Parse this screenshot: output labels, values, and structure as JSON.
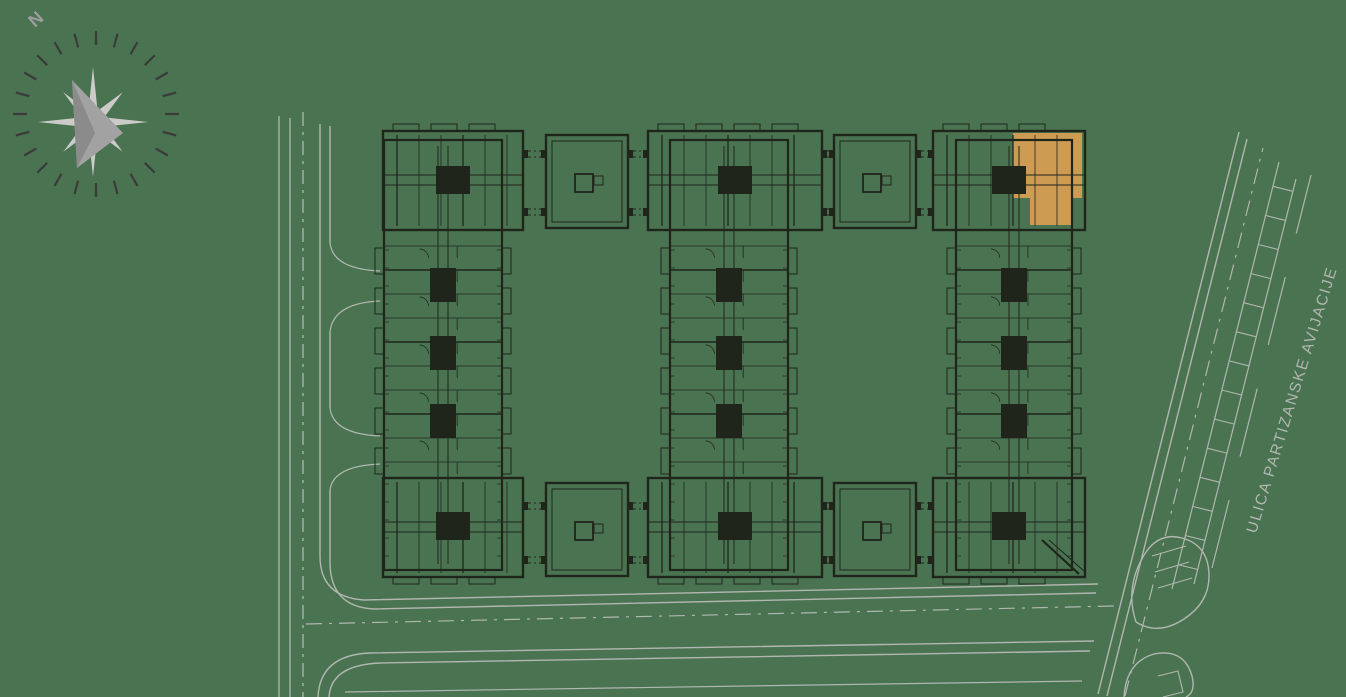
{
  "compass": {
    "north_label": "N"
  },
  "street": {
    "name": "ULICA PARTIZANSKE AVIJACIJE"
  },
  "highlighted_unit": {
    "points": "1013,133 1082,133 1082,198 1072,198 1072,225 1030,225 1030,198 1013,198"
  },
  "colors": {
    "background": "#4a7351",
    "plan_lines": "#20251c",
    "highlight": "#cd9b52",
    "road_lines": "#b1b7b0",
    "street_text": "#b1b7b0",
    "compass_ticks": "#3b3b3b",
    "compass_star_light": "#cccbc9",
    "compass_star_mid": "#a2a2a2",
    "compass_star_dark": "#8b8b8b",
    "north_text": "#9e9e9e"
  },
  "plan": {
    "wing_y1": 140,
    "wing_y2": 570,
    "wings": [
      {
        "x": 384,
        "w": 118
      },
      {
        "x": 670,
        "w": 118
      },
      {
        "x": 956,
        "w": 116
      }
    ],
    "blocks": [
      {
        "x": 383,
        "w": 140
      },
      {
        "x": 648,
        "w": 174
      },
      {
        "x": 933,
        "w": 152
      }
    ],
    "block_rows": [
      {
        "y": 131,
        "core_y": 166,
        "bal_y": 124
      },
      {
        "y": 478,
        "core_y": 512,
        "bal_y": 577
      }
    ],
    "block_h": 99,
    "squares": {
      "w": 82,
      "h": 93,
      "list": [
        [
          546,
          135
        ],
        [
          834,
          135
        ],
        [
          546,
          483
        ],
        [
          834,
          483
        ]
      ]
    },
    "connectors": {
      "rows": [
        {
          "ys": [
            151,
            209
          ]
        },
        {
          "ys": [
            503,
            557
          ]
        }
      ],
      "x_pairs": [
        [
          523,
          546
        ],
        [
          628,
          648
        ],
        [
          822,
          834
        ],
        [
          916,
          933
        ]
      ]
    },
    "wing_cores_y": [
      268,
      336,
      404
    ],
    "diagonal_cut": [
      [
        1042,
        540,
        1079,
        574
      ],
      [
        1049,
        540,
        1084,
        571
      ]
    ]
  },
  "roads": {
    "paths": [
      {
        "d": "M279,116 L279,697",
        "w": 1.3
      },
      {
        "d": "M290,118 L290,697",
        "w": 1.3
      },
      {
        "d": "M303,112 L303,697",
        "w": 1.3,
        "dash": "14 6 3 6"
      },
      {
        "d": "M320,124 L320,556 Q320,597 364,600 L1098,584",
        "w": 1.4
      },
      {
        "d": "M330,126 L330,243",
        "w": 1.4
      },
      {
        "d": "M330,332 L330,408",
        "w": 1.4
      },
      {
        "d": "M330,490 L330,564 Q331,607 374,609 L1096,593",
        "w": 1.4
      },
      {
        "d": "M330,243 Q333,269 380,271",
        "w": 1.2
      },
      {
        "d": "M380,301 Q333,303 330,332",
        "w": 1.2
      },
      {
        "d": "M330,408 Q333,434 380,436",
        "w": 1.2
      },
      {
        "d": "M380,464 Q333,466 330,490",
        "w": 1.2
      },
      {
        "d": "M306,624 L1114,606",
        "w": 1.2,
        "dash": "16 7 3 7"
      },
      {
        "d": "M318,697 Q320,655 370,653 L1094,641",
        "w": 1.4
      },
      {
        "d": "M329,697 Q331,665 380,663 L1090,651",
        "w": 1.4
      },
      {
        "d": "M345,692 L1082,681",
        "w": 1.2
      },
      {
        "d": "M1098,694 L1239,132",
        "w": 1.4
      },
      {
        "d": "M1107,696 L1247,139",
        "w": 1.4
      },
      {
        "d": "M1125,696 L1263,148",
        "w": 1.2,
        "dash": "16 7 3 7"
      },
      {
        "d": "M1172,589 L1279,162",
        "w": 1.2
      },
      {
        "d": "M1194,584 L1296,179",
        "w": 1.2
      },
      {
        "d": "M1212,568 L1311,175",
        "w": 1.2,
        "dash": "70 45"
      },
      {
        "d": "M1136,622 Q1124,586 1146,552 Q1160,532 1182,538 Q1208,545 1209,574 Q1210,602 1184,619 Q1158,636 1136,622",
        "w": 1.4
      },
      {
        "d": "M1152,556 L1186,546",
        "w": 1.1
      },
      {
        "d": "M1155,572 L1189,562",
        "w": 1.1
      },
      {
        "d": "M1158,588 L1192,578",
        "w": 1.1
      },
      {
        "d": "M1124,697 Q1126,662 1154,654 Q1184,648 1192,676 Q1196,692 1186,697",
        "w": 1.4
      },
      {
        "d": "M1158,676 L1178,671 L1183,692 L1163,697",
        "w": 1.1
      }
    ],
    "parking_rungs": {
      "bx": 1098,
      "by": 694,
      "ux": 0.2436,
      "uy": -0.9699,
      "px": 0.9699,
      "py": 0.2436,
      "k1": 46,
      "k2": 66,
      "t0": 145,
      "t1": 540,
      "step": 30
    }
  }
}
